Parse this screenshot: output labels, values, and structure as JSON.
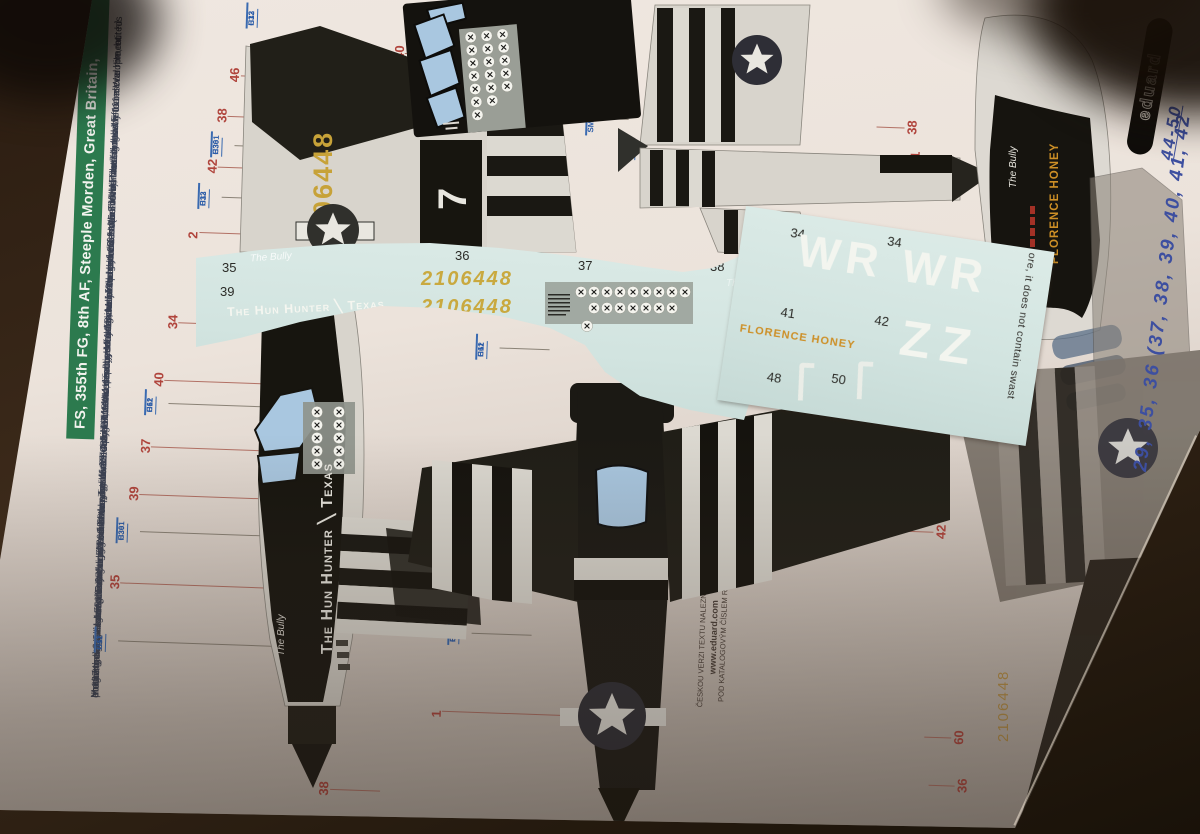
{
  "page": {
    "banner": "FS, 355th FG, 8th AF, Steeple Morden, Great Britain,",
    "bio": [
      "down to eight aircraft, damaging three other aircraft. On the ground he destroyed 14.5 and damaged 10. He achieved four wins with",
      "Mustang. He became the 355th FG's fifth ace fighter on April 24, 1944, and by May 13, he even held the status of the most",
      "ace of the entire group. Returning from leave, he then became the most successful fighter of the entire 8th Air Force in late August after",
      "on the ground and seven in the air in a 30-day period. Further increases in his score were halted by a German flak hit that forced",
      "him to make an emergency landing on enemy soil on 3 October 1944. His commander, Maj. Chuck Lenfest (5.5 kills), landed nearby to rescue him, but his",
      "Mustang bogged down in the mud and both pilots eventually fell into captivity. He remained in the service after the war and led the F-111 development",
      "program at Nellis AFB. Later he was commander of the 48th TFW and deputy commander of operations for the 7th AF during the Vietnam War. He retired",
      "in 1974 and died on 19 February 2008 at the age of 85."
    ],
    "footer": {
      "line1": "ČESKOU VERZI TEXTU NALEZNETE NA",
      "line2": "www.eduard.com",
      "line3": "POD KATALOGOVÝM ČÍSLEM R0019"
    }
  },
  "brand": {
    "logo": "eduard"
  },
  "handwriting": {
    "line1": "29, 35, 36 (37, 38, 39, 40, 41, 42",
    "line2": "44-50"
  },
  "decal": {
    "serial": "2106448",
    "nose_art": "The Hun Hunter ╲ Texas",
    "script": "The Bully",
    "florence": "FLORENCE HONEY",
    "wr": "WR WR",
    "zz": "ZZ",
    "note": "ore, it does not contain swast",
    "numbers": {
      "n34": "34",
      "n35": "35",
      "n36": "36",
      "n37": "37",
      "n38": "38",
      "n39": "39",
      "n40": "40",
      "n41": "41",
      "n42": "42",
      "n48": "48",
      "n50": "50"
    }
  },
  "artwork": {
    "fin_serial": "2106448",
    "code_letter": "7",
    "nose_art": "The Hun Hunter ╲ Texas",
    "script": "The Bully",
    "florence": "FLORENCE HONEY",
    "underside_serial": "2106448"
  },
  "callouts": {
    "n1": "1",
    "n2": "2",
    "n34": "34",
    "n35": "35",
    "n36": "36",
    "n37": "37",
    "n38": "38",
    "n39": "39",
    "n40": "40",
    "n41": "41",
    "n42": "42",
    "n46": "46",
    "n60": "60"
  },
  "paint": {
    "white": {
      "a": "H11",
      "b": "C62"
    },
    "black": {
      "a": "H12",
      "b": "C33"
    },
    "green": {
      "a": "H30",
      "b": "C361"
    },
    "silver": {
      "a": "H8",
      "b": "C8"
    },
    "metal": {
      "a": "SM201"
    }
  },
  "colors": {
    "banner_green": "#2c7a4e",
    "callout_red": "#b0443c",
    "paint_code_blue": "#2b5ca8",
    "decal_sheet": "#d5e6e2",
    "serial_yellow": "#c9a93f",
    "florence_orange": "#cd8f26",
    "handwriting_blue": "#3d4fa0"
  }
}
